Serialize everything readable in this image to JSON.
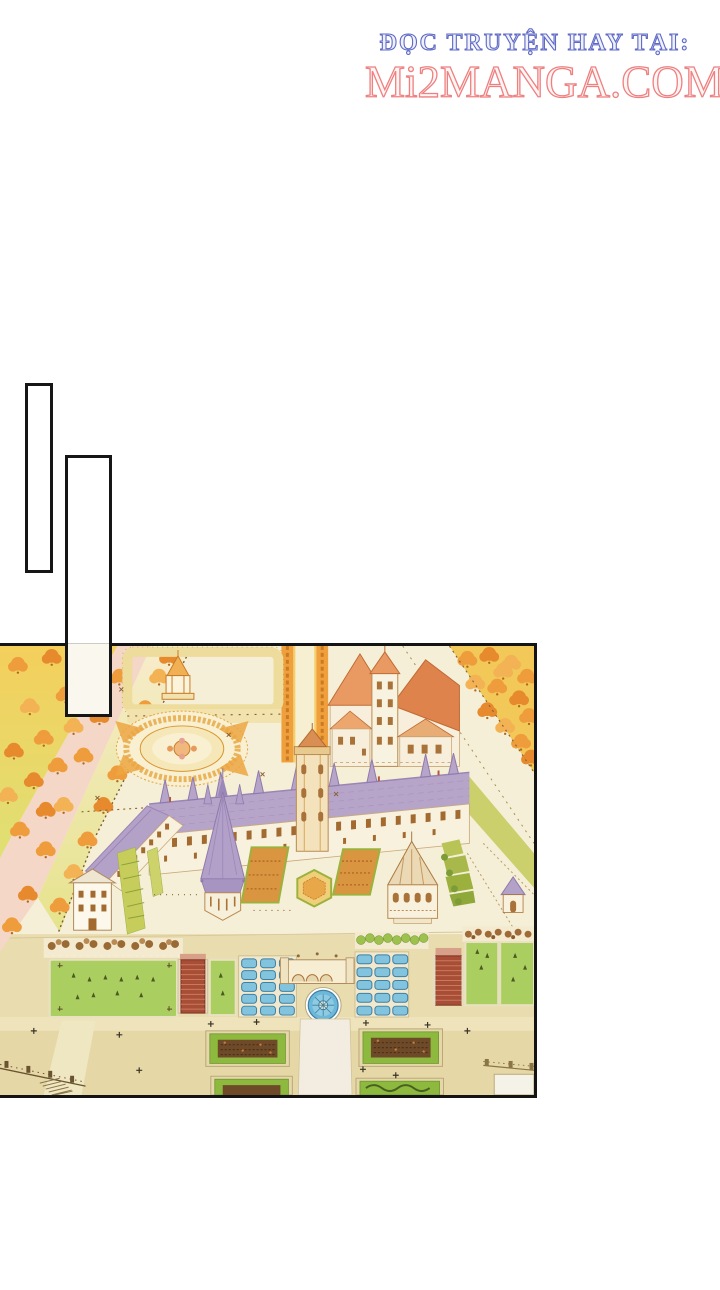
{
  "page": {
    "width": 720,
    "height": 1290,
    "background": "#ffffff"
  },
  "header": {
    "line1": "ĐỌC TRUYỆN HAY TẠI:",
    "line2": "Mi2MANGA.COM",
    "line1_color": "#5f6ac6",
    "line2_color": "#ee8080"
  },
  "bubbles": [
    {
      "name": "speech-bubble-1",
      "text": ""
    },
    {
      "name": "speech-bubble-2",
      "text": ""
    }
  ],
  "panel": {
    "type": "manga-panel-illustration",
    "description": "Aerial view of a grand palace estate in autumn: lavender-roofed château wings and a gothic chapel, an orange-roofed keep, tree-lined avenues, an oval fountain parterre, green lawns, blue water basins, a round blue fountain, red brick stairways and box parterres.",
    "border_color": "#141414",
    "palette": {
      "cream": "#f6efd7",
      "terrace_tan": "#e9dcae",
      "autumn_yellow": "#f4cf5c",
      "autumn_orange": "#ef9d3c",
      "road_pink": "#f4d7c6",
      "roof_lavender": "#b6a4c9",
      "roof_orange": "#e89a62",
      "wall_cream": "#f8f1dd",
      "lawn_green": "#abce60",
      "hedge_green": "#9cc14c",
      "water_blue": "#82c4de",
      "stair_red": "#a84e36",
      "parterre_brown": "#6e4a29",
      "line_brown": "#a97840"
    }
  }
}
